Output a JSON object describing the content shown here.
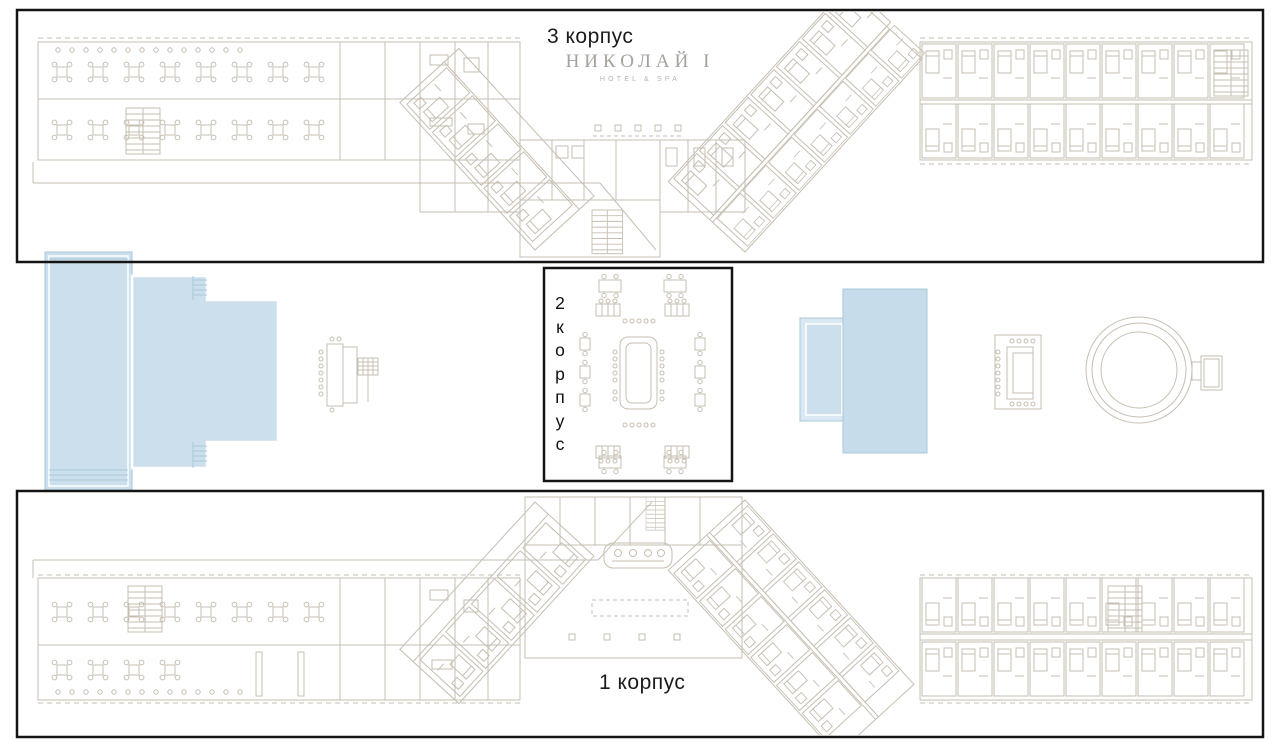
{
  "logo": {
    "name": "НИКОЛАЙ I",
    "tagline": "HOTEL & SPA"
  },
  "buildings": {
    "b3": {
      "label": "3 корпус"
    },
    "b2": {
      "label": "2 корпус",
      "letters": [
        "2",
        "к",
        "о",
        "р",
        "п",
        "у",
        "с"
      ]
    },
    "b1": {
      "label": "1 корпус"
    }
  },
  "colors": {
    "pool_fill": "#cbdfec",
    "pool_edge": "#a9c8db",
    "plan_line": "#c6beb1",
    "frame": "#141414",
    "logo_gray": "#a5a19c"
  }
}
